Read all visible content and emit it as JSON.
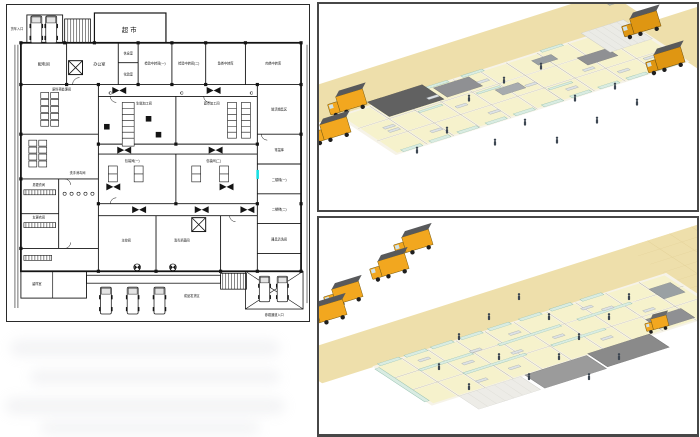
{
  "plan": {
    "c_mark": "C",
    "rooms": [
      {
        "id": "supermarket",
        "label": "超市"
      },
      {
        "id": "truck-entrance",
        "label": "货车入口"
      },
      {
        "id": "power-room",
        "label": "配电间"
      },
      {
        "id": "office",
        "label": "办公室"
      },
      {
        "id": "rest-room",
        "label": "休息室"
      },
      {
        "id": "lab",
        "label": "化验室"
      },
      {
        "id": "inspection-transfer-1",
        "label": "检验中转间(一)"
      },
      {
        "id": "inspection-transfer-2",
        "label": "检验中转间(二)"
      },
      {
        "id": "fish-transfer",
        "label": "鱼类中转库"
      },
      {
        "id": "meat-transfer",
        "label": "肉类中转库"
      },
      {
        "id": "fresh-sales",
        "label": "鲜活销售区"
      },
      {
        "id": "ambient-store",
        "label": "常温库"
      },
      {
        "id": "stair-2f-1",
        "label": "二楼梯(一)"
      },
      {
        "id": "stair-2f-2",
        "label": "二楼梯(二)"
      },
      {
        "id": "utensil-wash",
        "label": "器具清洗间"
      },
      {
        "id": "fresh-processing",
        "label": "生鲜加工间"
      },
      {
        "id": "pastry-processing",
        "label": "面点加工间"
      },
      {
        "id": "packing-1",
        "label": "包装间(一)"
      },
      {
        "id": "packing-2",
        "label": "包装间(二)"
      },
      {
        "id": "raw-pretreatment",
        "label": "原料预处理间"
      },
      {
        "id": "men-changing",
        "label": "男更衣间"
      },
      {
        "id": "women-changing",
        "label": "女更衣间"
      },
      {
        "id": "hand-wash",
        "label": "洗手消毒间"
      },
      {
        "id": "sample-room",
        "label": "留样室"
      },
      {
        "id": "control-room",
        "label": "主控间"
      },
      {
        "id": "sterilize-room",
        "label": "消毒杀菌间"
      },
      {
        "id": "dispatch-area",
        "label": "成品发货区"
      },
      {
        "id": "visitor-entrance",
        "label": "参观通道入口"
      }
    ]
  },
  "colors": {
    "plan_line": "#141414",
    "highlight": "#18dfe3",
    "apron": "#eedfab",
    "apron_grid": "#e0cd93",
    "room_floor": "#f6f2cc",
    "wall_white": "#f6f3e8",
    "wall_edge": "#aeaa9a",
    "glass": "#d9ece2",
    "glass_edge": "#8fbcab",
    "equipment_gray": "#8f9093",
    "roof_dark": "#616161",
    "roof_light": "#ebebe6",
    "truck_yellow": "#f2a71f",
    "truck_amber": "#df9612",
    "truck_top_gray": "#58595b",
    "person_dark": "#3d4752"
  }
}
